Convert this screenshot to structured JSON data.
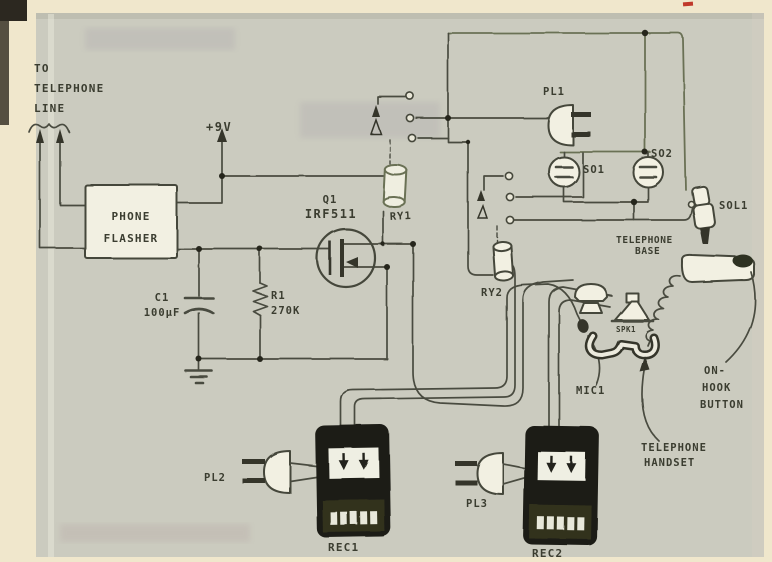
{
  "figure": {
    "type": "hand-drawn schematic",
    "subject": "Telephone line-activated recorder / flasher circuit"
  },
  "colors": {
    "page_cream": "#f0e7cc",
    "paper_panel": "#cbcbbf",
    "ink": "#4a4b3f",
    "olive_ink": "#6b7154",
    "module_black": "#1c1c15",
    "red_mark": "#c0392b"
  },
  "labels": {
    "to_telephone_line": [
      "TO",
      "TELEPHONE",
      "LINE"
    ],
    "supply": "+9V",
    "phone_flasher": [
      "PHONE",
      "FLASHER"
    ],
    "q1": [
      "Q1",
      "IRF511"
    ],
    "c1": [
      "C1",
      "100μF"
    ],
    "r1": [
      "R1",
      "270K"
    ],
    "ry1": "RY1",
    "ry2": "RY2",
    "pl1": "PL1",
    "pl2": "PL2",
    "pl3": "PL3",
    "so1": "SO1",
    "so2": "SO2",
    "sol1": "SOL1",
    "telephone_base": [
      "TELEPHONE",
      "BASE"
    ],
    "mic1": "MIC1",
    "spk1": "SPK1",
    "on_hook_button": [
      "ON-",
      "HOOK",
      "BUTTON"
    ],
    "telephone_handset": [
      "TELEPHONE",
      "HANDSET"
    ],
    "rec1": "REC1",
    "rec2": "REC2"
  }
}
